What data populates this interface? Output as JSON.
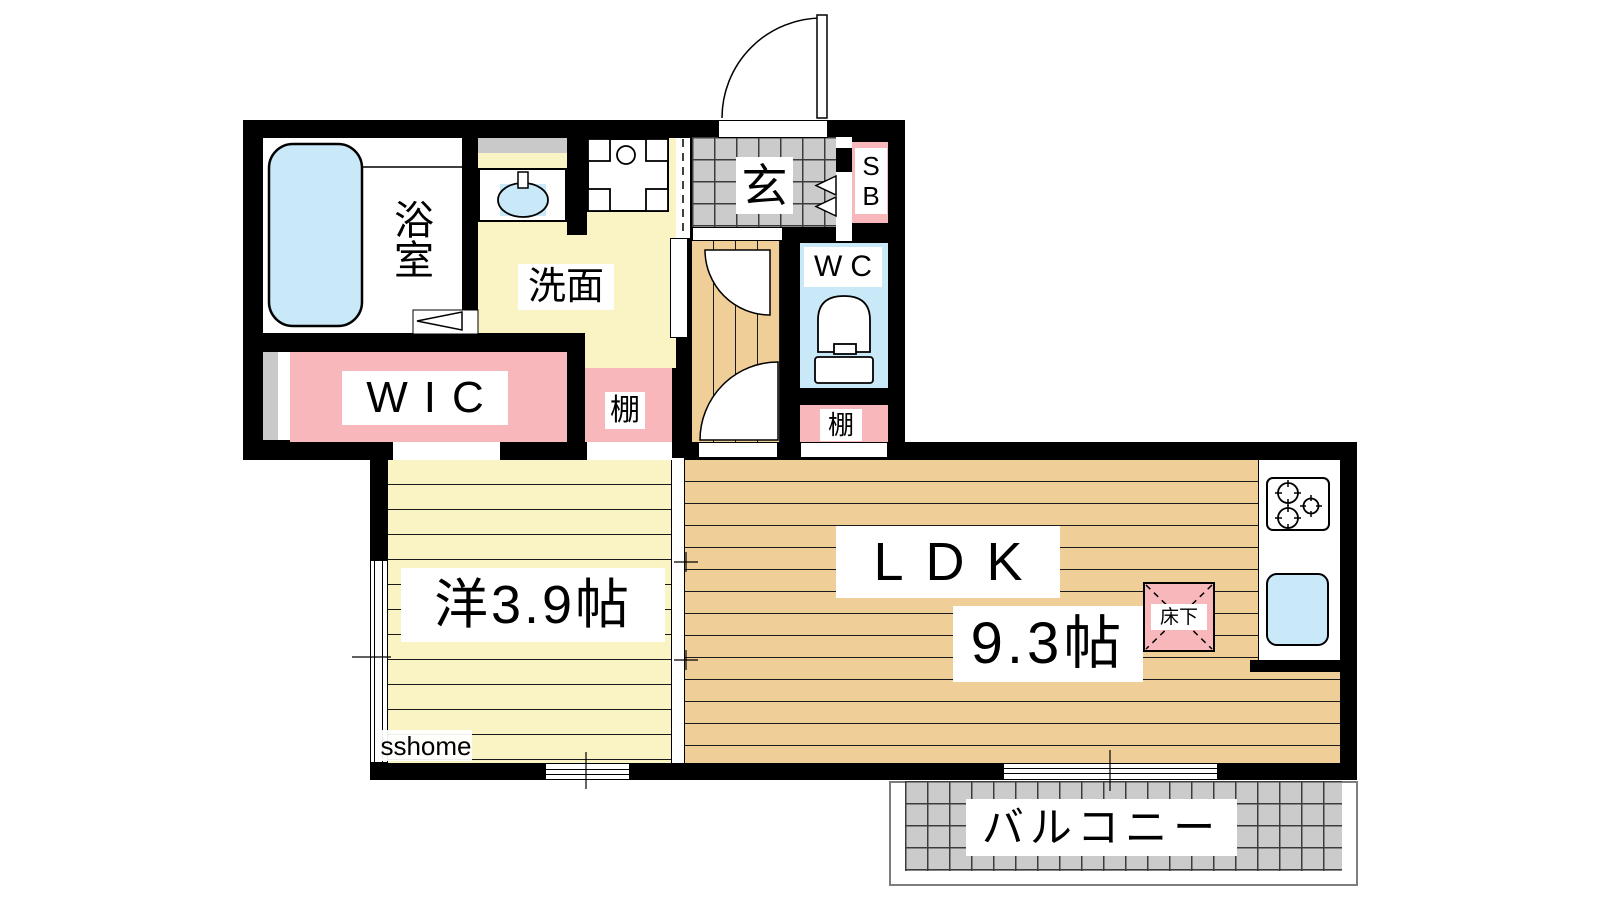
{
  "watermark": "sshome",
  "rooms": {
    "bathroom": "浴室",
    "washroom": "洗面",
    "wic": "WIC",
    "entrance": "玄",
    "shoe_box": "SB",
    "toilet": "WC",
    "shelf_upper": "棚",
    "shelf_lower": "棚",
    "western_room": "洋3.9帖",
    "ldk": "LDK",
    "ldk_size": "9.3帖",
    "underfloor_storage": "床下",
    "balcony": "バルコニー"
  },
  "fixtures": [
    "bathtub-icon",
    "washbasin-icon",
    "washing-machine-icon",
    "toilet-icon",
    "stove-icon",
    "kitchen-sink-icon",
    "door-swing-arc-icon",
    "entrance-door-arc-icon"
  ],
  "colors": {
    "wall": "#000000",
    "floor_wood": "#F0CE97",
    "floor_yellow": "#FAF4C5",
    "accent_pink": "#F8B7BB",
    "fixture_blue": "#C9E9F9",
    "tile_gray": "#CBCBCB",
    "plank_line": "#1A1A1A"
  }
}
